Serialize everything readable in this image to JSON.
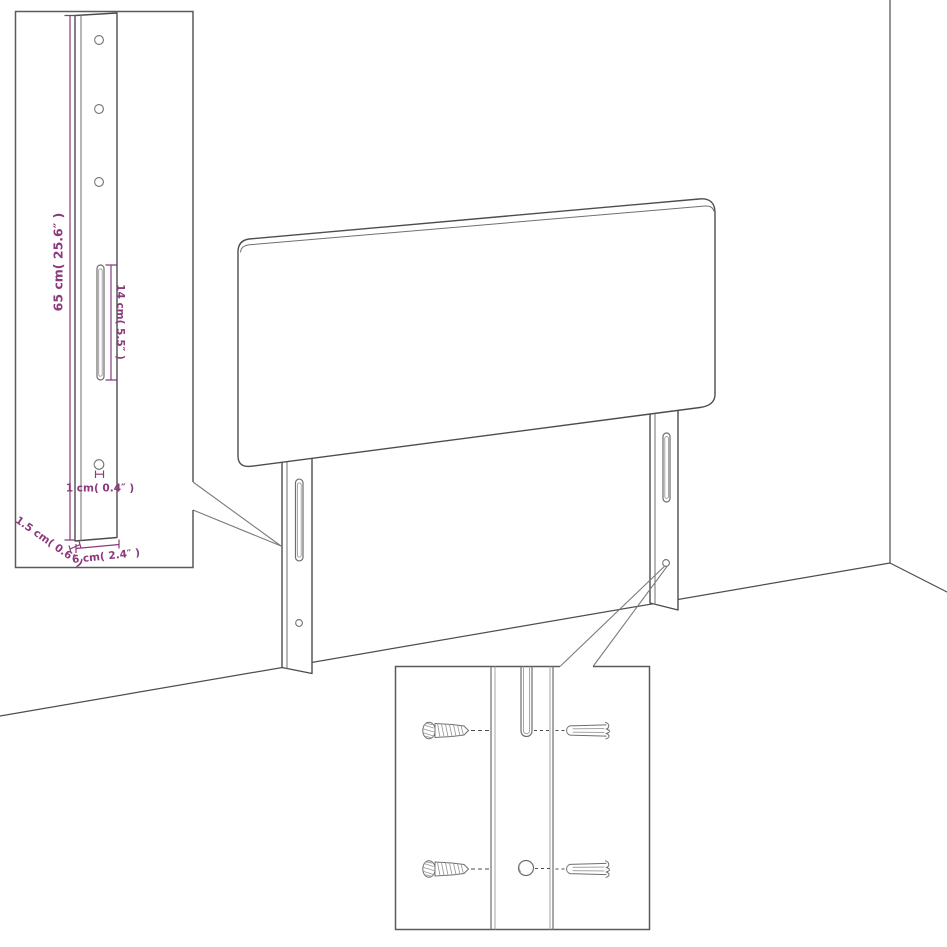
{
  "page": {
    "background": "#ffffff"
  },
  "diagram": {
    "colors": {
      "outline": "#4d4d4d",
      "dimension_accent": "#8b3a7d"
    },
    "labels": {
      "height": "65 cm( 25.6″ )",
      "slot_length": "14 cm( 5.5″ )",
      "hole_diameter": "1 cm( 0.4″ )",
      "leg_thickness": "1.5 cm( 0.6″ )",
      "leg_width": "6 cm( 2.4″ )"
    }
  }
}
